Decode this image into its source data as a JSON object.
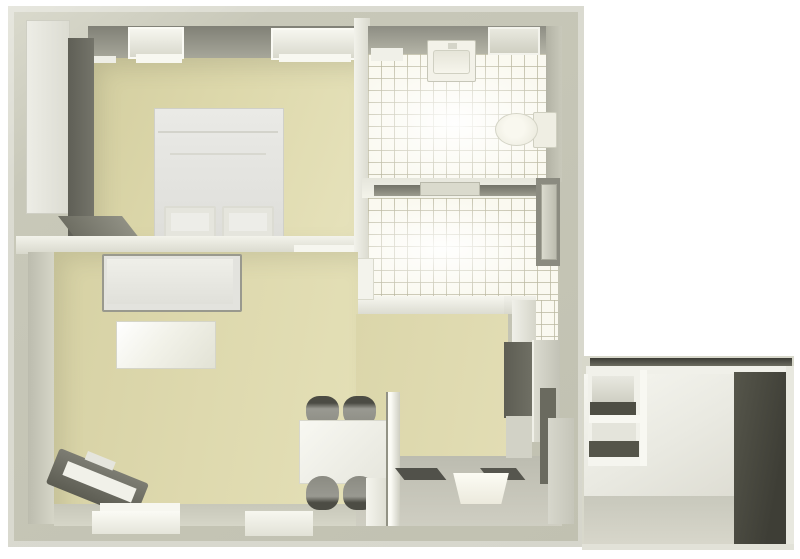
{
  "scene": {
    "width": 800,
    "height": 559,
    "background": "#ffffff",
    "kind": "3d-floor-plan-top-view"
  },
  "palette": {
    "background": "#ffffff",
    "wall_top": "#c6c6b7",
    "wall_highlight": "#f2f2ea",
    "wall_shadow_face": "#8d8d83",
    "floor_beige": "#ded9ae",
    "tile_floor": "#faf9f0",
    "tile_grout": "#bebca5",
    "kitchen_gray": "#c5c5b9",
    "furniture_dark": "#5f5f55",
    "furniture_light": "#ecece6",
    "annex_dark_wall": "#46463d"
  },
  "rooms": [
    {
      "label": "bedroom",
      "floor": "beige"
    },
    {
      "label": "bathroom",
      "floor": "white-tile"
    },
    {
      "label": "hallway",
      "floor": "white-tile"
    },
    {
      "label": "living-dining-room",
      "floor": "beige"
    },
    {
      "label": "kitchen",
      "floor": "gray"
    },
    {
      "label": "annex-storage",
      "floor": "gray"
    }
  ],
  "elements": [
    {
      "name": "building-outer-wall",
      "x": 8,
      "y": 6,
      "w": 576,
      "h": 541,
      "bg": "linear-gradient(145deg,#dadacd 0%,#c8c8b9 20%,#c1c1b1 100%)",
      "shadow": "inset 0 0 0 6px rgba(255,255,255,0.35)"
    },
    {
      "name": "annex-base",
      "x": 582,
      "y": 356,
      "w": 212,
      "h": 192,
      "bg": "#d8d8cb"
    },
    {
      "name": "annex-top-wall-dark",
      "x": 590,
      "y": 358,
      "w": 202,
      "h": 8,
      "bg": "linear-gradient(180deg,#3c3c35,#6b6b5f)"
    },
    {
      "name": "annex-top-wall-white",
      "x": 586,
      "y": 366,
      "w": 206,
      "h": 9,
      "bg": "#f0f0e9"
    },
    {
      "name": "annex-interior-wall",
      "x": 584,
      "y": 374,
      "w": 152,
      "h": 130,
      "bg": "linear-gradient(150deg,#f6f6f0 0%,#e9e9e1 55%,#dddcd2 100%)"
    },
    {
      "name": "annex-floor",
      "x": 584,
      "y": 496,
      "w": 152,
      "h": 50,
      "bg": "linear-gradient(180deg,#c8c8bc,#d8d7cb)"
    },
    {
      "name": "annex-dark-wall",
      "x": 734,
      "y": 372,
      "w": 54,
      "h": 174,
      "bg": "linear-gradient(100deg,#56564b,#3e3e36 75%)"
    },
    {
      "name": "annex-right-edge",
      "x": 786,
      "y": 366,
      "w": 8,
      "h": 182,
      "bg": "#e8e8df"
    },
    {
      "name": "annex-bottom-edge",
      "x": 582,
      "y": 544,
      "w": 212,
      "h": 6,
      "bg": "#e2e2d8"
    },
    {
      "name": "annex-shelf-unit",
      "x": 588,
      "y": 370,
      "w": 56,
      "h": 96,
      "bg": "#f1f1ea"
    },
    {
      "name": "annex-shelf-opening-top",
      "x": 592,
      "y": 376,
      "w": 42,
      "h": 26,
      "bg": "linear-gradient(180deg,#e8e8e0,#cfcfc3)"
    },
    {
      "name": "annex-shelf-board-dark-1",
      "x": 590,
      "y": 402,
      "w": 46,
      "h": 13,
      "bg": "#4e4e44"
    },
    {
      "name": "annex-shelf-board-white",
      "x": 589,
      "y": 415,
      "w": 52,
      "h": 8,
      "bg": "#f7f7f1"
    },
    {
      "name": "annex-shelf-opening-mid",
      "x": 592,
      "y": 423,
      "w": 44,
      "h": 18,
      "bg": "#e4e4db"
    },
    {
      "name": "annex-shelf-board-dark-2",
      "x": 589,
      "y": 441,
      "w": 50,
      "h": 16,
      "bg": "#55554a"
    },
    {
      "name": "annex-shelf-bottom",
      "x": 588,
      "y": 457,
      "w": 56,
      "h": 9,
      "bg": "#f5f5ef"
    },
    {
      "name": "annex-shelf-side-panel",
      "x": 640,
      "y": 370,
      "w": 7,
      "h": 96,
      "bg": "#f8f8f2"
    },
    {
      "name": "bedroom-wall-face",
      "x": 88,
      "y": 26,
      "w": 270,
      "h": 34,
      "bg": "linear-gradient(180deg,#808076,#a9a99c)"
    },
    {
      "name": "bedroom-floor",
      "x": 88,
      "y": 58,
      "w": 270,
      "h": 180,
      "bg": "linear-gradient(110deg,#d3cea0 0%,#ddd8ab 45%,#e6e2bb 100%)",
      "shadow": "inset 12px 10px 22px rgba(95,95,75,0.18)"
    },
    {
      "name": "bedroom-window-1",
      "x": 128,
      "y": 27,
      "w": 52,
      "h": 28,
      "bg": "linear-gradient(180deg,#f6f6ef,#d8d8cc)",
      "border": "2px solid #fafaf4"
    },
    {
      "name": "bedroom-window-1-sill",
      "x": 136,
      "y": 54,
      "w": 46,
      "h": 9,
      "bg": "#f8f8f1"
    },
    {
      "name": "bedroom-sill-small",
      "x": 92,
      "y": 56,
      "w": 24,
      "h": 7,
      "bg": "#eeeee6"
    },
    {
      "name": "bedroom-window-2",
      "x": 271,
      "y": 28,
      "w": 82,
      "h": 28,
      "bg": "linear-gradient(180deg,#f6f6ef,#d8d8cc)",
      "border": "2px solid #fafaf4"
    },
    {
      "name": "bedroom-window-2-sill",
      "x": 279,
      "y": 54,
      "w": 72,
      "h": 8,
      "bg": "#f8f8f1"
    },
    {
      "name": "wardrobe-front",
      "x": 26,
      "y": 20,
      "w": 42,
      "h": 192,
      "bg": "linear-gradient(90deg,#edede6,#dcdcd2)",
      "border": "1px solid #cfcfc4"
    },
    {
      "name": "wardrobe-side-face",
      "x": 68,
      "y": 38,
      "w": 26,
      "h": 198,
      "bg": "linear-gradient(90deg,#5f5f56,#74746a)"
    },
    {
      "name": "wardrobe-base-shadow",
      "x": 58,
      "y": 216,
      "w": 64,
      "h": 24,
      "transform": "skewX(38deg)",
      "origin": "top left",
      "bg": "linear-gradient(90deg,#6e6e63,#909084)"
    },
    {
      "name": "bed",
      "x": 154,
      "y": 108,
      "w": 128,
      "h": 130,
      "bg": "linear-gradient(180deg,#eaeae6,#dededa)",
      "border": "1px solid #d0d0c8"
    },
    {
      "name": "bed-seam-1",
      "x": 158,
      "y": 131,
      "w": 120,
      "h": 2,
      "bg": "#d3d3cb"
    },
    {
      "name": "bed-seam-2",
      "x": 170,
      "y": 153,
      "w": 96,
      "h": 2,
      "bg": "#d8d8d0"
    },
    {
      "name": "bed-pillow-1",
      "x": 164,
      "y": 206,
      "w": 48,
      "h": 28,
      "bg": "#edede8",
      "border": "2px solid #dcdcd3",
      "shadow": "inset 0 0 0 5px #e5e5dd",
      "radius": "2px"
    },
    {
      "name": "bed-pillow-2",
      "x": 222,
      "y": 206,
      "w": 48,
      "h": 28,
      "bg": "#edede8",
      "border": "2px solid #dcdcd3",
      "shadow": "inset 0 0 0 5px #e5e5dd",
      "radius": "2px"
    },
    {
      "name": "bedroom-living-wall",
      "x": 16,
      "y": 236,
      "w": 344,
      "h": 18,
      "bg": "linear-gradient(180deg,#f3f3eb,#d8d8cc)"
    },
    {
      "name": "bedroom-door-threshold",
      "x": 294,
      "y": 245,
      "w": 62,
      "h": 11,
      "bg": "#f6f6ef",
      "shadow": "0 2px 0 rgba(110,110,95,0.6)"
    },
    {
      "name": "bath-left-wall",
      "x": 354,
      "y": 18,
      "w": 16,
      "h": 242,
      "bg": "linear-gradient(90deg,#f2f2eb,#d9d9cd)"
    },
    {
      "name": "bathroom-wall-face",
      "x": 368,
      "y": 26,
      "w": 192,
      "h": 30,
      "bg": "linear-gradient(180deg,#8d8d83,#b7b7a9)"
    },
    {
      "name": "bathroom-floor",
      "x": 368,
      "y": 54,
      "w": 192,
      "h": 126,
      "cls": "tiles"
    },
    {
      "name": "bathroom-floor-sheen",
      "x": 368,
      "y": 54,
      "w": 192,
      "h": 126,
      "bg": "radial-gradient(ellipse at 45% 55%, rgba(255,255,255,0.95) 0%, rgba(255,255,255,0) 72%)"
    },
    {
      "name": "bathroom-right-wall-face",
      "x": 546,
      "y": 26,
      "w": 16,
      "h": 156,
      "bg": "linear-gradient(90deg,#b2b2a4,#c9c9bb)"
    },
    {
      "name": "bathroom-window",
      "x": 488,
      "y": 27,
      "w": 48,
      "h": 24,
      "bg": "linear-gradient(180deg,#e9e9df,#cfcfc2)",
      "border": "2px solid #f3f3ec"
    },
    {
      "name": "bathroom-shelf",
      "x": 371,
      "y": 48,
      "w": 32,
      "h": 13,
      "bg": "#f0f0e8"
    },
    {
      "name": "washbasin-unit",
      "x": 427,
      "y": 40,
      "w": 47,
      "h": 40,
      "bg": "#f3f2e9",
      "border": "1px solid #c6c6b8",
      "radius": "2px"
    },
    {
      "name": "washbasin-bowl",
      "x": 433,
      "y": 50,
      "w": 35,
      "h": 22,
      "bg": "linear-gradient(180deg,#e6e5d9,#f6f5ec)",
      "border": "1px solid #d0d0c2",
      "radius": "3px"
    },
    {
      "name": "washbasin-faucet",
      "x": 448,
      "y": 43,
      "w": 9,
      "h": 6,
      "bg": "#d5d5c9"
    },
    {
      "name": "toilet-tank",
      "x": 533,
      "y": 112,
      "w": 22,
      "h": 34,
      "bg": "#efeee3",
      "border": "1px solid #cfcfc0",
      "radius": "2px"
    },
    {
      "name": "toilet-bowl",
      "x": 495,
      "y": 113,
      "w": 41,
      "h": 31,
      "bg": "radial-gradient(circle at 45% 45%, #f9f8ef 35%, #e8e7da 100%)",
      "border": "1px solid #d4d4c6",
      "radius": "50%"
    },
    {
      "name": "bathroom-hall-wall",
      "x": 362,
      "y": 178,
      "w": 198,
      "h": 20,
      "bg": "linear-gradient(180deg,#e6e6dc,#f3f3ea)"
    },
    {
      "name": "bathroom-door-shadow",
      "x": 374,
      "y": 185,
      "w": 168,
      "h": 11,
      "bg": "linear-gradient(180deg,#727268,#9b9b8e)"
    },
    {
      "name": "bathroom-door-leaf",
      "x": 420,
      "y": 182,
      "w": 58,
      "h": 12,
      "bg": "#dadacd",
      "border": "1px solid #b9b9ab"
    },
    {
      "name": "hallway-floor",
      "x": 368,
      "y": 198,
      "w": 190,
      "h": 102,
      "cls": "tiles"
    },
    {
      "name": "hallway-floor-sheen",
      "x": 368,
      "y": 198,
      "w": 190,
      "h": 102,
      "bg": "radial-gradient(ellipse at 40% 50%, rgba(255,255,255,0.9) 0%, rgba(255,255,255,0) 70%)"
    },
    {
      "name": "hallway-floor-column",
      "x": 528,
      "y": 300,
      "w": 30,
      "h": 48,
      "cls": "tiles"
    },
    {
      "name": "hallway-l-wall",
      "x": 356,
      "y": 296,
      "w": 160,
      "h": 18,
      "bg": "linear-gradient(180deg,#f7f7f0,#dcdcd1)"
    },
    {
      "name": "hallway-l-wall-corner",
      "x": 504,
      "y": 296,
      "w": 32,
      "h": 18,
      "bg": "linear-gradient(180deg,#f2f2eb,#d8d8cd)"
    },
    {
      "name": "hallway-l-wall-vertical",
      "x": 512,
      "y": 300,
      "w": 24,
      "h": 50,
      "bg": "linear-gradient(90deg,#f0f0e9,#d5d5c9)"
    },
    {
      "name": "hallway-living-threshold",
      "x": 348,
      "y": 258,
      "w": 24,
      "h": 40,
      "bg": "#f3f3ec",
      "border": "1px solid #d9d9cc"
    },
    {
      "name": "entrance-door-jamb",
      "x": 536,
      "y": 178,
      "w": 24,
      "h": 88,
      "bg": "#8b8b80"
    },
    {
      "name": "entrance-door-leaf",
      "x": 541,
      "y": 184,
      "w": 14,
      "h": 74,
      "bg": "linear-gradient(90deg,#dadace,#bcbcaf)",
      "border": "1px solid #a7a79a"
    },
    {
      "name": "living-left-wall-face",
      "x": 28,
      "y": 252,
      "w": 28,
      "h": 272,
      "bg": "linear-gradient(90deg,#bcbcae,#d7d7c9)"
    },
    {
      "name": "living-floor",
      "x": 54,
      "y": 252,
      "w": 304,
      "h": 274,
      "bg": "linear-gradient(100deg,#d6d1a4 0%,#ded9ae 50%,#e4e0b7 100%)",
      "shadow": "inset 10px 8px 20px rgba(95,95,75,0.15)"
    },
    {
      "name": "dining-floor",
      "x": 356,
      "y": 314,
      "w": 152,
      "h": 148,
      "bg": "linear-gradient(100deg,#dbd6aa,#e2ddb4)"
    },
    {
      "name": "kitchen-floor",
      "x": 356,
      "y": 456,
      "w": 206,
      "h": 70,
      "bg": "linear-gradient(180deg,#bcbcb0,#cfcec2)"
    },
    {
      "name": "living-bottom-wall-face",
      "x": 54,
      "y": 504,
      "w": 302,
      "h": 22,
      "bg": "linear-gradient(180deg,#c7c7b9,#d6d6c8)"
    },
    {
      "name": "sofa-back",
      "x": 102,
      "y": 254,
      "w": 136,
      "h": 54,
      "bg": "#e3e3de",
      "border": "2px solid #99998e",
      "radius": "2px"
    },
    {
      "name": "sofa-seat",
      "x": 107,
      "y": 259,
      "w": 126,
      "h": 45,
      "bg": "linear-gradient(180deg,#efefe9,#e0e0da)"
    },
    {
      "name": "coffee-table",
      "x": 116,
      "y": 321,
      "w": 98,
      "h": 46,
      "bg": "linear-gradient(130deg,#ffffff 0%,#f2f2e9 45%,#e2e2d5 100%)",
      "border": "1px solid #d5d5c8"
    },
    {
      "name": "tv-bench-body",
      "x": 60,
      "y": 448,
      "w": 96,
      "h": 38,
      "transform": "rotate(22deg)",
      "origin": "top left",
      "bg": "linear-gradient(180deg,#7d7d73,#5d5d53)",
      "radius": "3px"
    },
    {
      "name": "tv-bench-inner",
      "x": 68,
      "y": 461,
      "w": 74,
      "h": 15,
      "transform": "rotate(22deg)",
      "origin": "top left",
      "bg": "#f1f1e9"
    },
    {
      "name": "tv-bench-tab",
      "x": 88,
      "y": 451,
      "w": 30,
      "h": 9,
      "transform": "rotate(22deg)",
      "origin": "top left",
      "bg": "#e5e5dd"
    },
    {
      "name": "living-window-sill",
      "x": 100,
      "y": 503,
      "w": 80,
      "h": 8,
      "bg": "#f7f7f0"
    },
    {
      "name": "living-window-1",
      "x": 92,
      "y": 511,
      "w": 88,
      "h": 23,
      "bg": "linear-gradient(180deg,#fbfbf5,#e5e5da)"
    },
    {
      "name": "living-window-2",
      "x": 245,
      "y": 511,
      "w": 68,
      "h": 25,
      "bg": "linear-gradient(180deg,#f7f7f0,#e2e2d7)"
    },
    {
      "name": "dining-chair-1",
      "x": 306,
      "y": 396,
      "w": 33,
      "h": 32,
      "bg": "linear-gradient(180deg,#4c4c44 0%,#4c4c44 22%,#999991 40%,#8b8b82 100%)",
      "radius": "40% 40% 48% 48%"
    },
    {
      "name": "dining-chair-2",
      "x": 343,
      "y": 396,
      "w": 33,
      "h": 32,
      "bg": "linear-gradient(180deg,#4c4c44 0%,#4c4c44 22%,#999991 40%,#8b8b82 100%)",
      "radius": "40% 40% 48% 48%"
    },
    {
      "name": "dining-table",
      "x": 299,
      "y": 420,
      "w": 86,
      "h": 62,
      "bg": "linear-gradient(135deg,#f8f8f2,#e6e6dd)",
      "border": "1px solid #d8d8cd"
    },
    {
      "name": "dining-chair-3",
      "x": 306,
      "y": 476,
      "w": 33,
      "h": 34,
      "bg": "linear-gradient(0deg,#4c4c44 0%,#4c4c44 22%,#999991 40%,#8b8b82 100%)",
      "radius": "48% 48% 40% 40%"
    },
    {
      "name": "dining-chair-4",
      "x": 343,
      "y": 476,
      "w": 33,
      "h": 34,
      "bg": "linear-gradient(0deg,#4c4c44 0%,#4c4c44 22%,#999991 40%,#8b8b82 100%)",
      "radius": "48% 48% 40% 40%"
    },
    {
      "name": "kitchen-partition-wall",
      "x": 386,
      "y": 392,
      "w": 14,
      "h": 134,
      "bg": "linear-gradient(90deg,#fbfbf5 35%,#cecec2)",
      "shadow": "inset 2px 0 0 rgba(120,120,105,0.8)"
    },
    {
      "name": "kitchen-door-leaf",
      "x": 366,
      "y": 478,
      "w": 20,
      "h": 48,
      "bg": "linear-gradient(90deg,#f5f5ee,#dfdfd4)"
    },
    {
      "name": "counter-shadow-1",
      "x": 395,
      "y": 468,
      "w": 42,
      "h": 12,
      "transform": "skewX(38deg)",
      "origin": "top left",
      "bg": "#51514a"
    },
    {
      "name": "counter-shadow-2",
      "x": 480,
      "y": 468,
      "w": 36,
      "h": 12,
      "transform": "skewX(38deg)",
      "origin": "top left",
      "bg": "#56564e"
    },
    {
      "name": "kitchen-sink",
      "x": 452,
      "y": 473,
      "w": 58,
      "h": 31,
      "clip": "polygon(2% 0, 98% 0, 85% 100%, 15% 100%)",
      "bg": "linear-gradient(180deg,#fcfcf4,#eceadd)"
    },
    {
      "name": "kitchen-cabinet-dark-a",
      "x": 504,
      "y": 342,
      "w": 28,
      "h": 76,
      "bg": "linear-gradient(90deg,#5d5d53,#6f6f64)"
    },
    {
      "name": "kitchen-wall-patch",
      "x": 506,
      "y": 416,
      "w": 26,
      "h": 42,
      "bg": "#d2d2c6"
    },
    {
      "name": "kitchen-cabinet-light-b",
      "x": 532,
      "y": 340,
      "w": 28,
      "h": 102,
      "bg": "linear-gradient(90deg,#dcdcd1,#c2c2b6)",
      "shadow": "inset 2px 0 0 #f0f0e8"
    },
    {
      "name": "kitchen-cabinet-dark-c",
      "x": 540,
      "y": 388,
      "w": 16,
      "h": 96,
      "bg": "#6a6a5f"
    },
    {
      "name": "kitchen-cabinet-light-d",
      "x": 548,
      "y": 418,
      "w": 26,
      "h": 106,
      "bg": "linear-gradient(90deg,#d7d7cc,#c5c5b9)"
    }
  ]
}
